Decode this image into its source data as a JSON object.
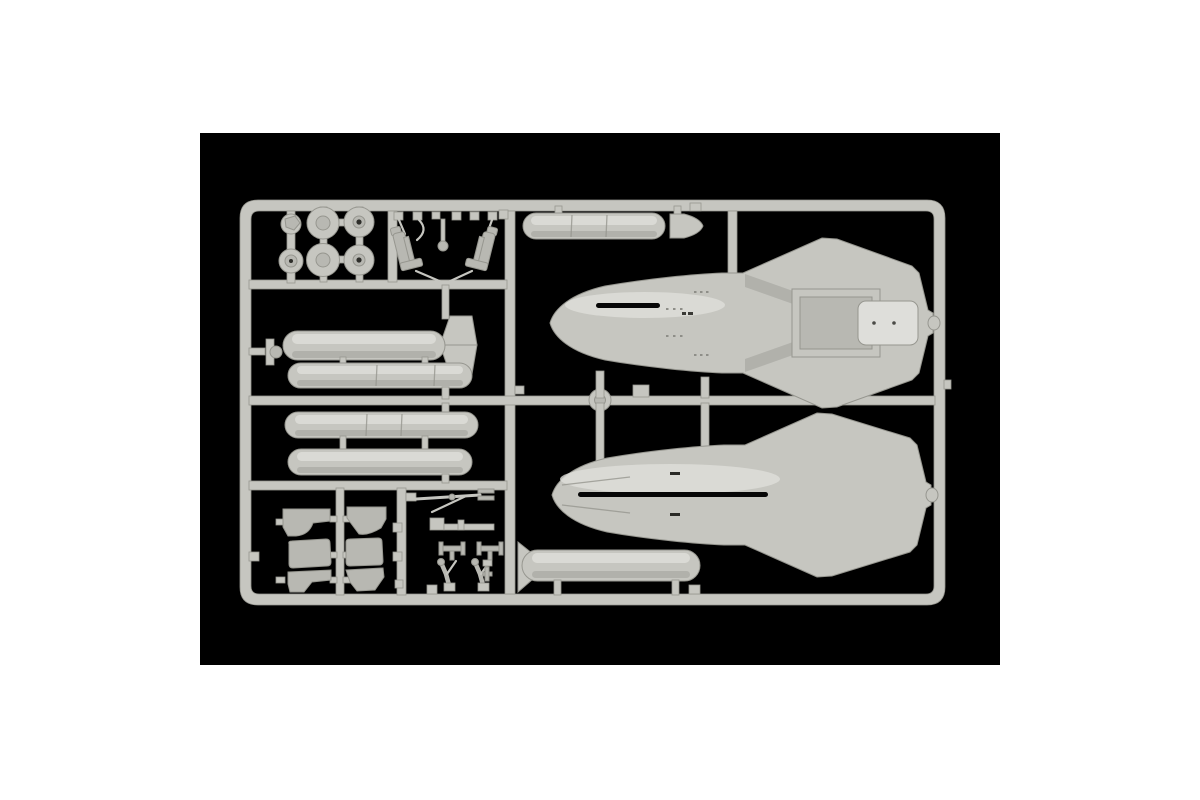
{
  "scene": {
    "type": "product photograph",
    "subject": "Light grey injection-moulded sprue (parts tree) from a model aircraft kit, photographed on a black background",
    "page_background": "#ffffff",
    "photo_background": "#000000",
    "colors": {
      "plastic": "#c6c6c0",
      "plastic-light": "#dededa",
      "plastic-mid": "#b8b8b2",
      "plastic-dark": "#96968f",
      "plastic-shadow": "#a6a6a0",
      "slot": "#060606",
      "hub-dark": "#2e2e2a"
    }
  },
  "sprue": {
    "material": "polystyrene",
    "colour_name": "light grey",
    "parts": [
      {
        "name": "upper-fuselage-half",
        "count": 1,
        "desc": "Fuselage top half with integral delta wings, intake fairings, engine deck and cockpit slot"
      },
      {
        "name": "lower-fuselage-half",
        "count": 1,
        "desc": "Fuselage bottom half with integral delta wings and long centre join slot"
      },
      {
        "name": "drop-tank",
        "count": 6,
        "desc": "External fuel tank halves; two with tail fins, one with a separate nose cone, three with segment seams"
      },
      {
        "name": "main-wheel",
        "count": 4,
        "desc": "Round wheel discs, two with open hub holes"
      },
      {
        "name": "wheel-hub",
        "count": 2,
        "desc": "Small round hub / retraction parts"
      },
      {
        "name": "ejection-seat",
        "count": 2,
        "desc": "Crew seats moulded at opposing angles with harness and frame details"
      },
      {
        "name": "canopy-frame",
        "count": 6,
        "desc": "Windscreen and canopy framing pieces in two columns"
      },
      {
        "name": "landing-gear-leg",
        "count": 2,
        "desc": "Articulated main undercarriage struts with foot pads"
      },
      {
        "name": "gear-axle",
        "count": 2,
        "desc": "Small axle cross pieces"
      },
      {
        "name": "probe-strut",
        "count": 1,
        "desc": "Long thin probe / nose gear strut with diagonal brace"
      },
      {
        "name": "small-bracket",
        "count": 12,
        "desc": "Assorted square tabs, pads and brackets moulded on the runners"
      }
    ]
  }
}
